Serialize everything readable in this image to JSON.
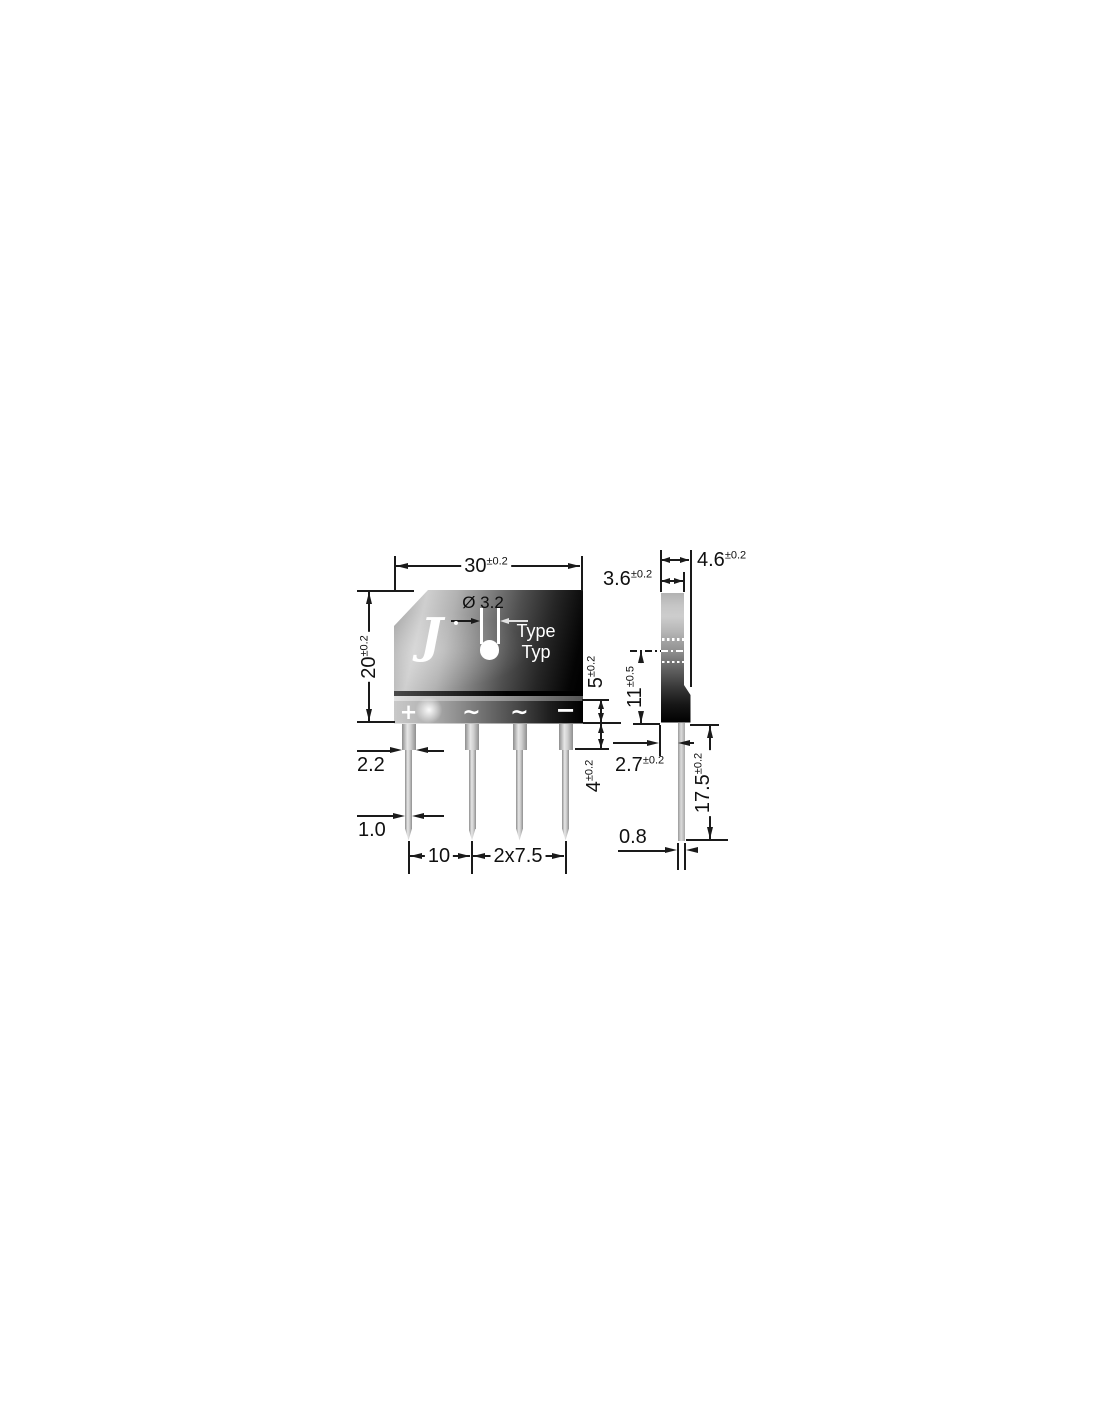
{
  "front_view": {
    "logo_letter": "J",
    "hole_diameter_label": "Ø 3.2",
    "marking_line1": "Type",
    "marking_line2": "Typ",
    "terminal_symbols": [
      "+",
      "∼",
      "∼",
      "−"
    ],
    "dims": {
      "body_width": {
        "value": "30",
        "tol": "±0.2"
      },
      "body_height": {
        "value": "20",
        "tol": "±0.2"
      },
      "strip_height": {
        "value": "5",
        "tol": "±0.2"
      },
      "shoulder_length": {
        "value": "4",
        "tol": "±0.2"
      },
      "lead_width_wide": {
        "value": "2.2",
        "tol": ""
      },
      "lead_width_narrow": {
        "value": "1.0",
        "tol": ""
      },
      "lead_pitch_outer": {
        "value": "10",
        "tol": ""
      },
      "lead_pitch_inner": {
        "value": "2x7.5",
        "tol": ""
      }
    }
  },
  "side_view": {
    "dims": {
      "depth_total": {
        "value": "4.6",
        "tol": "±0.2"
      },
      "depth_upper": {
        "value": "3.6",
        "tol": "±0.2"
      },
      "hole_center_height": {
        "value": "11",
        "tol": "±0.5"
      },
      "lead_offset": {
        "value": "2.7",
        "tol": "±0.2"
      },
      "lead_length": {
        "value": "17.5",
        "tol": "±0.2"
      },
      "lead_thickness": {
        "value": "0.8",
        "tol": ""
      }
    }
  },
  "colors": {
    "line": "#1a1a1a",
    "text": "#101010",
    "body_light": "#cdcdcd",
    "body_dark": "#000000",
    "pin_metal": "#cfcfcf",
    "background": "#ffffff"
  }
}
